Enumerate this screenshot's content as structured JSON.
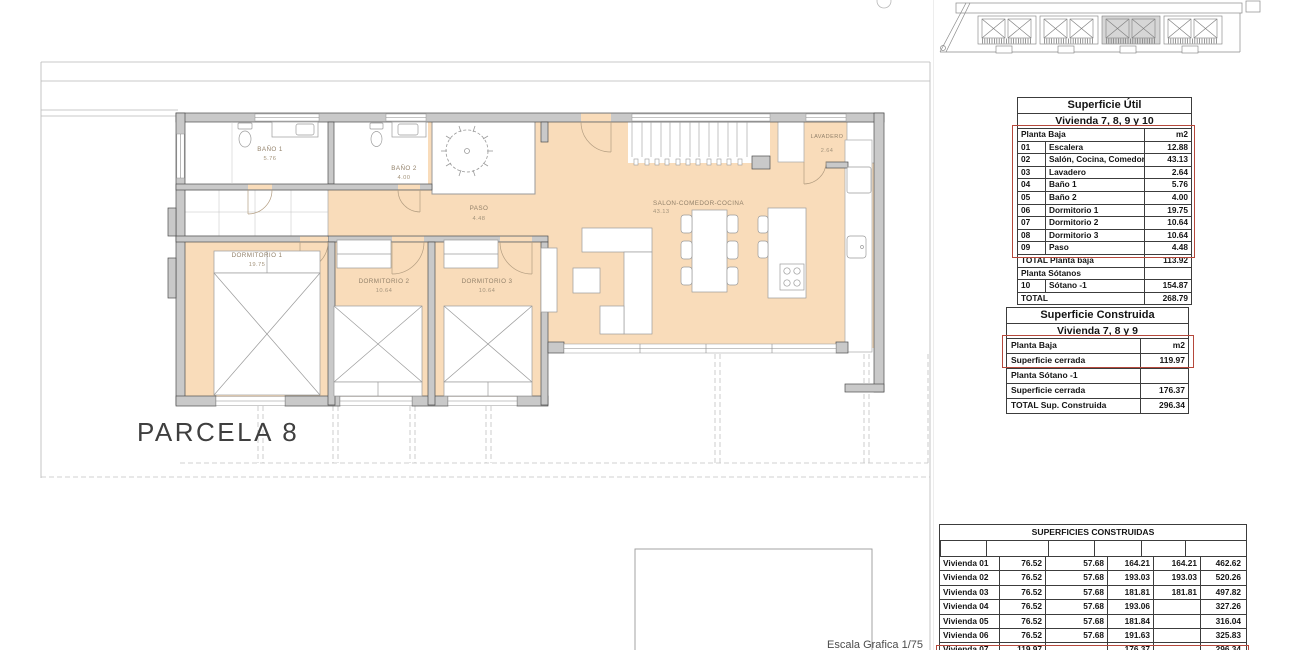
{
  "plan": {
    "parcela_label": "PARCELA 8",
    "escala_label": "Escala Grafica 1/75",
    "rooms": {
      "bano1": {
        "name": "BAÑO 1",
        "area": "5.76"
      },
      "bano2": {
        "name": "BAÑO 2",
        "area": "4.00"
      },
      "paso": {
        "name": "PASO",
        "area": "4.48"
      },
      "lavadero": {
        "name": "LAVADERO",
        "area": "2.64"
      },
      "dorm1": {
        "name": "DORMITORIO 1",
        "area": "19.75"
      },
      "dorm2": {
        "name": "DORMITORIO 2",
        "area": "10.64"
      },
      "dorm3": {
        "name": "DORMITORIO 3",
        "area": "10.64"
      },
      "salon": {
        "name": "SALON-COMEDOR-COCINA",
        "area": "43.13"
      }
    }
  },
  "tables": {
    "util": {
      "title1": "Superficie Útil",
      "title2": "Vivienda 7, 8, 9 y 10",
      "rows": [
        {
          "cls": "hdr",
          "cells": [
            "",
            "Planta Baja",
            "m2"
          ]
        },
        {
          "cls": "num",
          "cells": [
            "01",
            "Escalera",
            "12.88"
          ]
        },
        {
          "cls": "num",
          "cells": [
            "02",
            "Salón, Cocina, Comedor",
            "43.13"
          ]
        },
        {
          "cls": "num",
          "cells": [
            "03",
            "Lavadero",
            "2.64"
          ]
        },
        {
          "cls": "num",
          "cells": [
            "04",
            "Baño 1",
            "5.76"
          ]
        },
        {
          "cls": "num",
          "cells": [
            "05",
            "Baño 2",
            "4.00"
          ]
        },
        {
          "cls": "num",
          "cells": [
            "06",
            "Dormitorio 1",
            "19.75"
          ]
        },
        {
          "cls": "num",
          "cells": [
            "07",
            "Dormitorio 2",
            "10.64"
          ]
        },
        {
          "cls": "num",
          "cells": [
            "08",
            "Dormitorio 3",
            "10.64"
          ]
        },
        {
          "cls": "num",
          "cells": [
            "09",
            "Paso",
            "4.48"
          ]
        },
        {
          "cls": "total",
          "cells": [
            "",
            "TOTAL Planta baja",
            "113.92"
          ]
        },
        {
          "cls": "hdr",
          "cells": [
            "",
            "Planta Sótanos",
            ""
          ]
        },
        {
          "cls": "num",
          "cells": [
            "10",
            "Sótano -1",
            "154.87"
          ]
        },
        {
          "cls": "total",
          "cells": [
            "",
            "TOTAL",
            "268.79"
          ]
        }
      ]
    },
    "construida": {
      "title1": "Superficie Construida",
      "title2": "Vivienda 7, 8 y 9",
      "rows": [
        {
          "cls": "hdr",
          "cells": [
            "Planta Baja",
            "m2"
          ]
        },
        {
          "cells": [
            "Superficie cerrada",
            "119.97"
          ]
        },
        {
          "cls": "hdr",
          "cells": [
            "Planta Sótano -1",
            ""
          ]
        },
        {
          "cells": [
            "Superficie cerrada",
            "176.37"
          ]
        },
        {
          "cls": "total",
          "cells": [
            "TOTAL Sup. Construida",
            "296.34"
          ]
        }
      ]
    },
    "superficies": {
      "title": "SUPERFICIES CONSTRUIDAS",
      "columns": [
        "",
        "P. BAJA",
        "P. PRIMERA",
        "SÓTANO -1",
        "SÓTANO -2",
        "TOTAL"
      ],
      "rows": [
        {
          "cells": [
            "Vivienda 01",
            "76.52",
            "57.68",
            "164.21",
            "164.21",
            "462.62"
          ]
        },
        {
          "cells": [
            "Vivienda 02",
            "76.52",
            "57.68",
            "193.03",
            "193.03",
            "520.26"
          ]
        },
        {
          "cells": [
            "Vivienda 03",
            "76.52",
            "57.68",
            "181.81",
            "181.81",
            "497.82"
          ]
        },
        {
          "cells": [
            "Vivienda 04",
            "76.52",
            "57.68",
            "193.06",
            "",
            "327.26"
          ]
        },
        {
          "cells": [
            "Vivienda 05",
            "76.52",
            "57.68",
            "181.84",
            "",
            "316.04"
          ]
        },
        {
          "cells": [
            "Vivienda 06",
            "76.52",
            "57.68",
            "191.63",
            "",
            "325.83"
          ]
        },
        {
          "cells": [
            "Vivienda 07",
            "119.97",
            "",
            "176.37",
            "",
            "296.34"
          ]
        },
        {
          "cls": "partial",
          "cells": [
            "",
            "119.97",
            "",
            "176.37",
            "",
            "296.34"
          ]
        }
      ]
    }
  },
  "colors": {
    "floor_peach": "#f9dcba",
    "wall_gray": "#c9c9c9",
    "highlight_red": "#b5483b"
  }
}
